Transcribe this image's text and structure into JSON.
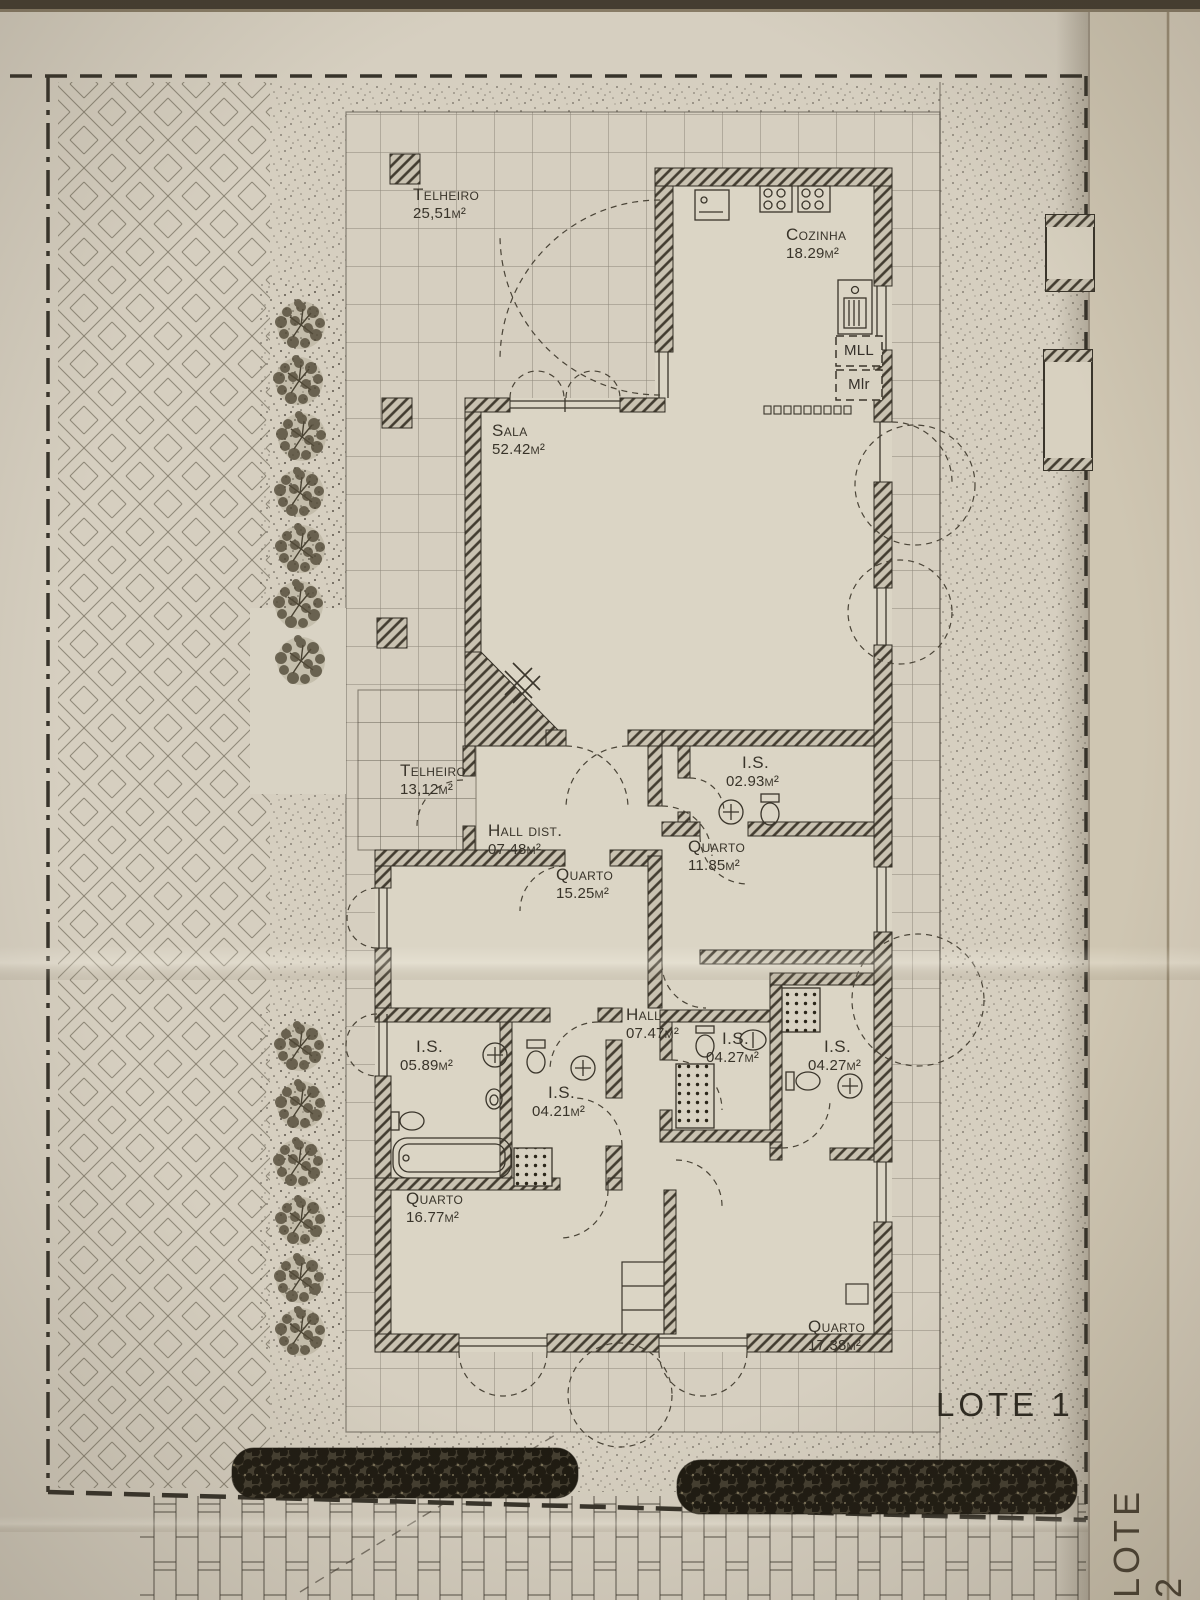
{
  "plan": {
    "lot_label": "LOTE 1",
    "adjacent_lot_label": "LOTE 2",
    "rooms": [
      {
        "name": "Telheiro",
        "area": "25,51m²"
      },
      {
        "name": "Cozinha",
        "area": "18.29m²"
      },
      {
        "name": "Sala",
        "area": "52.42m²"
      },
      {
        "name": "Telheiro",
        "area": "13,12m²"
      },
      {
        "name": "Hall dist.",
        "area": "07.48m²"
      },
      {
        "name": "Quarto",
        "area": "15.25m²"
      },
      {
        "name": "I.S.",
        "area": "02.93m²"
      },
      {
        "name": "Quarto",
        "area": "11.85m²"
      },
      {
        "name": "Hall",
        "area": "07.47m²"
      },
      {
        "name": "I.S.",
        "area": "05.89m²"
      },
      {
        "name": "I.S.",
        "area": "04.21m²"
      },
      {
        "name": "I.S.",
        "area": "04.27m²"
      },
      {
        "name": "I.S.",
        "area": "04.27m²"
      },
      {
        "name": "Quarto",
        "area": "16.77m²"
      },
      {
        "name": "Quarto",
        "area": "17.38m²"
      }
    ],
    "appliance_labels": {
      "dishwasher": "MLL",
      "washing_machine": "Mlr"
    },
    "fixture_icons": [
      "fireplace-icon",
      "stove-icon",
      "kitchen-sink-icon",
      "washbasin-icon",
      "toilet-icon",
      "bidet-icon",
      "bathtub-icon",
      "shower-icon",
      "tree-icon",
      "hedge",
      "planter",
      "radiator-icon",
      "closet"
    ],
    "colors": {
      "paper": "#d6cfc0",
      "fold_paper": "#cfc6b2",
      "ink": "#3a352b",
      "wall_hatch": "#423c30",
      "hedge": "#221d13"
    }
  }
}
